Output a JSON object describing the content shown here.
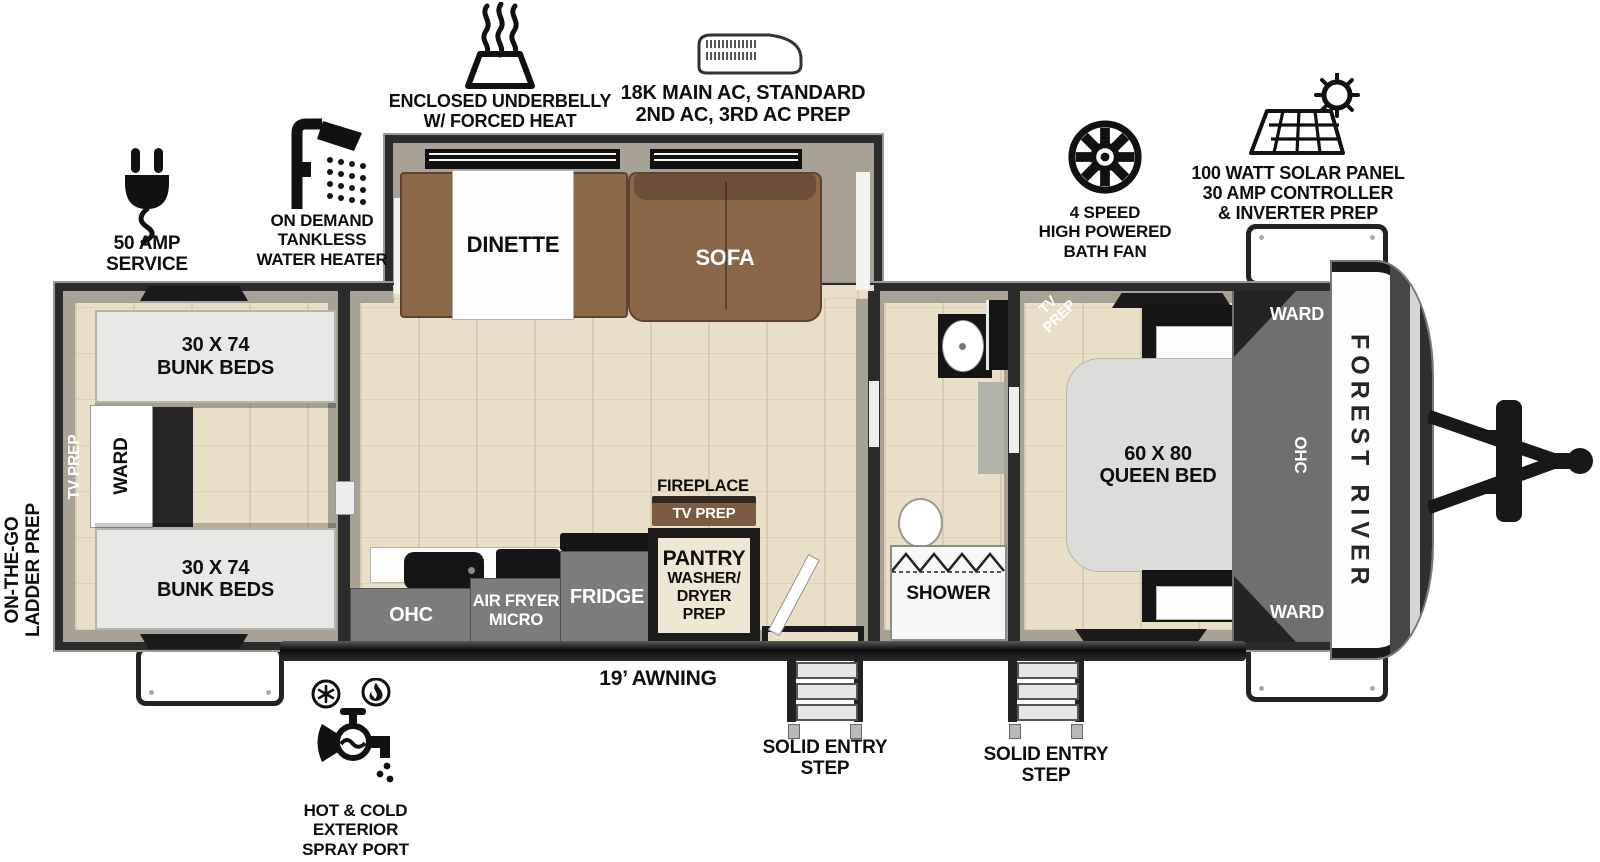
{
  "exterior": {
    "underbelly": "ENCLOSED UNDERBELLY\nW/ FORCED HEAT",
    "main_ac": "18K MAIN AC, STANDARD\n2ND AC, 3RD AC PREP",
    "bath_fan": "4 SPEED\nHIGH POWERED\nBATH FAN",
    "solar": "100 WATT SOLAR PANEL\n30 AMP CONTROLLER\n& INVERTER PREP",
    "amp_service": "50 AMP SERVICE",
    "water_heater": "ON DEMAND\nTANKLESS\nWATER HEATER",
    "ladder_prep": "ON-THE-GO\nLADDER PREP",
    "awning": "19’ AWNING",
    "entry_step_1": "SOLID ENTRY\nSTEP",
    "entry_step_2": "SOLID ENTRY\nSTEP",
    "spray_port": "HOT & COLD EXTERIOR\nSPRAY PORT"
  },
  "bunk_room": {
    "bunk_top": "30 X 74\nBUNK BEDS",
    "bunk_bottom": "30 X 74\nBUNK BEDS",
    "ward": "WARD",
    "tv_prep": "TV PREP"
  },
  "living": {
    "dinette": "DINETTE",
    "sofa": "SOFA",
    "ohc": "OHC",
    "air_fryer": "AIR FRYER\nMICRO",
    "fridge": "FRIDGE",
    "pantry_title": "PANTRY",
    "pantry_sub": "WASHER/\nDRYER PREP",
    "fireplace": "FIREPLACE",
    "fireplace_tv": "TV PREP"
  },
  "bath": {
    "shower": "SHOWER"
  },
  "bedroom": {
    "tv_prep": "TV\nPREP",
    "queen_bed": "60 X 80\nQUEEN BED"
  },
  "front": {
    "ward_top": "WARD",
    "ohc": "OHC",
    "ward_bottom": "WARD",
    "brand": "FOREST RIVER"
  },
  "colors": {
    "wall": "#2b2b2b",
    "interior_wall": "#a7a295",
    "floor": "#e9dec7",
    "sofa_brown": "#8a6748",
    "cabinet_gray": "#7c7c7c"
  }
}
